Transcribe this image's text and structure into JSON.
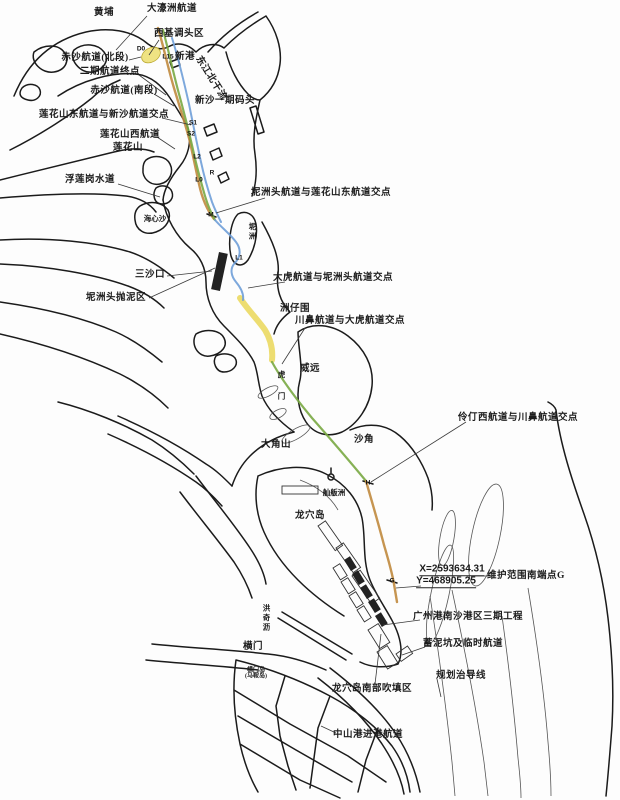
{
  "map": {
    "colors": {
      "coast": "#1b1b1b",
      "channel_orange": "#c08a3e",
      "channel_green": "#79a943",
      "channel_blue": "#6f9fd8",
      "channel_yellow": "#e8d44d",
      "basin_yellow": "#efe27d",
      "leader": "#3a3a3a",
      "background": "#fdfdfd"
    },
    "labels": [
      {
        "name": "label-huangpu",
        "text": "黄埔",
        "x": 104,
        "y": 14
      },
      {
        "name": "label-dahaozhou-channel",
        "text": "大濠洲航道",
        "x": 172,
        "y": 10,
        "leader": [
          147,
          16,
          116,
          50
        ]
      },
      {
        "name": "label-xiji-turning-basin",
        "text": "西基调头区",
        "x": 179,
        "y": 35,
        "leader": [
          159,
          40,
          149,
          55
        ]
      },
      {
        "name": "label-xingang",
        "text": "新港",
        "x": 185,
        "y": 58
      },
      {
        "name": "label-dongjiang-north",
        "text": "东江北干流",
        "x": 210,
        "y": 79,
        "rotate": 58
      },
      {
        "name": "label-chisha-north",
        "text": "赤沙航道(北段)",
        "x": 95,
        "y": 59,
        "leader": [
          129,
          60,
          141,
          57
        ]
      },
      {
        "name": "label-phase2-endpoint",
        "text": "二期航道终点",
        "x": 110,
        "y": 73,
        "leader": [
          139,
          75,
          166,
          95
        ]
      },
      {
        "name": "label-chisha-south",
        "text": "赤沙航道(南段)",
        "x": 124,
        "y": 92,
        "leader": [
          154,
          94,
          174,
          106
        ]
      },
      {
        "name": "label-xinsha-wharf",
        "text": "新沙一期码头",
        "x": 225,
        "y": 102
      },
      {
        "name": "label-lianhuashan-east-xinsha-junction",
        "text": "莲花山东航道与新沙航道交点",
        "x": 104,
        "y": 116,
        "leader": [
          162,
          118,
          191,
          125
        ]
      },
      {
        "name": "label-lianhuashan-west-channel",
        "text": "莲花山西航道",
        "x": 130,
        "y": 136,
        "leader": [
          157,
          137,
          175,
          149
        ]
      },
      {
        "name": "label-lianhuashan",
        "text": "莲花山",
        "x": 128,
        "y": 149
      },
      {
        "name": "label-fuliangang-waterway",
        "text": "浮莲岗水道",
        "x": 90,
        "y": 181,
        "leader": [
          118,
          184,
          160,
          197
        ]
      },
      {
        "name": "label-haixinsha",
        "text": "海心沙",
        "x": 155,
        "y": 219,
        "cls": "small"
      },
      {
        "name": "label-nizhou",
        "text": "坭洲",
        "x": 252,
        "y": 232,
        "cls": "v small"
      },
      {
        "name": "label-nizhoutou-lianhuashan-junction",
        "text": "坭洲头航道与莲花山东航道交点",
        "x": 321,
        "y": 194,
        "leader": [
          265,
          198,
          216,
          213
        ]
      },
      {
        "name": "label-sanshakou",
        "text": "三沙口",
        "x": 150,
        "y": 276,
        "leader": [
          167,
          276,
          212,
          271
        ]
      },
      {
        "name": "label-nizhoutou-dump",
        "text": "坭洲头抛泥区",
        "x": 116,
        "y": 299,
        "leader": [
          149,
          298,
          215,
          268
        ]
      },
      {
        "name": "label-dahu-nizhoutou-junction",
        "text": "大虎航道与坭洲头航道交点",
        "x": 333,
        "y": 279,
        "leader": [
          285,
          282,
          248,
          288
        ]
      },
      {
        "name": "label-zhouzaiwei",
        "text": "洲仔围",
        "x": 295,
        "y": 310
      },
      {
        "name": "label-chuanbi-dahu-junction",
        "text": "川鼻航道与大虎航道交点",
        "x": 350,
        "y": 322,
        "leader": [
          305,
          328,
          282,
          364
        ]
      },
      {
        "name": "label-weiyuan",
        "text": "威远",
        "x": 310,
        "y": 370
      },
      {
        "name": "label-humen",
        "text": "虎门",
        "x": 281,
        "y": 392,
        "cls": "vgap small"
      },
      {
        "name": "label-dajiaoshan",
        "text": "大角山",
        "x": 276,
        "y": 446
      },
      {
        "name": "label-shajiao",
        "text": "沙角",
        "x": 364,
        "y": 441
      },
      {
        "name": "label-lingdingxi-chuanbi-junction",
        "text": "伶仃西航道与川鼻航道交点",
        "x": 518,
        "y": 419,
        "leader": [
          466,
          422,
          371,
          482
        ]
      },
      {
        "name": "label-shanbanzhou",
        "text": "舢舨洲",
        "x": 334,
        "y": 493,
        "cls": "small"
      },
      {
        "name": "label-longxue-island",
        "text": "龙穴岛",
        "x": 310,
        "y": 517
      },
      {
        "name": "label-coord-x",
        "text": "X=2593634.31",
        "x": 452,
        "y": 570,
        "cls": "coord"
      },
      {
        "name": "label-coord-y",
        "text": "Y=468905.25",
        "x": 446,
        "y": 582,
        "cls": "coord",
        "leader": [
          421,
          586,
          396,
          588
        ]
      },
      {
        "name": "label-maintenance-south-point",
        "text": "维护范围南端点G",
        "x": 526,
        "y": 577,
        "leader": [
          471,
          576,
          494,
          576
        ]
      },
      {
        "name": "label-nansha-phase3",
        "text": "广州港南沙港区三期工程",
        "x": 468,
        "y": 618,
        "leader": [
          420,
          620,
          383,
          625
        ]
      },
      {
        "name": "label-mud-pit-temp-channel",
        "text": "蓄泥坑及临时航道",
        "x": 463,
        "y": 645,
        "leader": [
          425,
          647,
          402,
          655
        ]
      },
      {
        "name": "label-planning-guideline",
        "text": "规划治导线",
        "x": 461,
        "y": 677,
        "leader": [
          437,
          679,
          441,
          697
        ]
      },
      {
        "name": "label-longxue-south-reclamation",
        "text": "龙穴岛南部吹填区",
        "x": 372,
        "y": 690,
        "leader": [
          375,
          684,
          381,
          634
        ]
      },
      {
        "name": "label-zhongshan-approach-channel",
        "text": "中山港进港航道",
        "x": 368,
        "y": 736,
        "leader": [
          336,
          733,
          321,
          726
        ]
      },
      {
        "name": "label-hengmen",
        "text": "横门",
        "x": 253,
        "y": 648
      },
      {
        "name": "label-hongqili",
        "text": "洪奇沥",
        "x": 266,
        "y": 618,
        "cls": "v small"
      },
      {
        "name": "label-hengmen-island",
        "text": "横门岛\n(马鞍岛)",
        "x": 256,
        "y": 674,
        "cls": "tiny"
      }
    ],
    "channel_markers": [
      {
        "text": "D0",
        "x": 141,
        "y": 49
      },
      {
        "text": "L15",
        "x": 168,
        "y": 57
      },
      {
        "text": "S1",
        "x": 193,
        "y": 123
      },
      {
        "text": "S2",
        "x": 191,
        "y": 134
      },
      {
        "text": "L2",
        "x": 197,
        "y": 157
      },
      {
        "text": "L0",
        "x": 199,
        "y": 180
      },
      {
        "text": "R",
        "x": 212,
        "y": 173
      },
      {
        "text": "M",
        "x": 211,
        "y": 215
      },
      {
        "text": "L1",
        "x": 239,
        "y": 258
      },
      {
        "text": "H",
        "x": 368,
        "y": 483
      },
      {
        "text": "G",
        "x": 392,
        "y": 581
      }
    ],
    "coordinates_note": {
      "x_value": "X=2593634.31",
      "y_value": "Y=468905.25",
      "point": "G"
    }
  }
}
